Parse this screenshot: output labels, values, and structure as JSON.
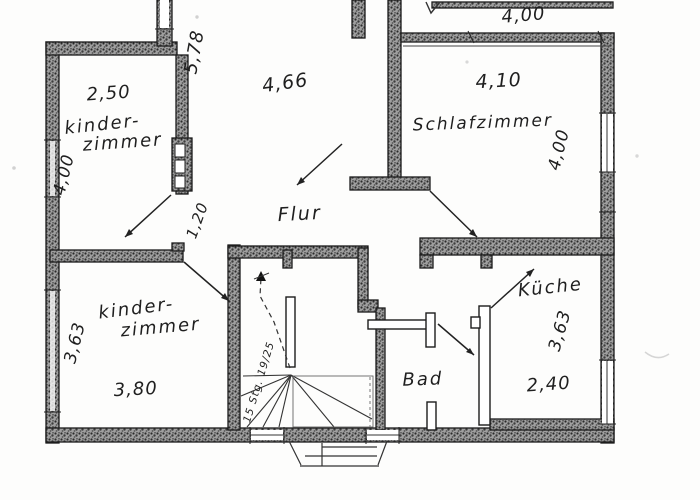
{
  "plan": {
    "rooms": {
      "kinderzimmer_top": {
        "line1": "kinder-",
        "line2": "zimmer"
      },
      "schlafzimmer": "Schlafzimmer",
      "flur": "Flur",
      "kinderzimmer_bottom": {
        "line1": "kinder-",
        "line2": "zimmer"
      },
      "bad": "Bad",
      "kueche": "Küche"
    },
    "dims": {
      "kz1_width": "2,50",
      "kz1_depth": "4,00",
      "hall_depth": "5,78",
      "hall_width": "4,66",
      "balcony_width": "4,00",
      "schlaf_width": "4,10",
      "schlaf_depth": "4,00",
      "flur_passage": "1,20",
      "kz2_depth": "3,63",
      "kz2_width": "3,80",
      "kueche_depth": "3,63",
      "kueche_width": "2,40"
    },
    "stairs": {
      "note": "15 Stg. 19/25"
    },
    "colors": {
      "ink": "#1f1f1f",
      "paper": "#fdfdfc",
      "wall_speckle": "#3a3a3a"
    }
  }
}
